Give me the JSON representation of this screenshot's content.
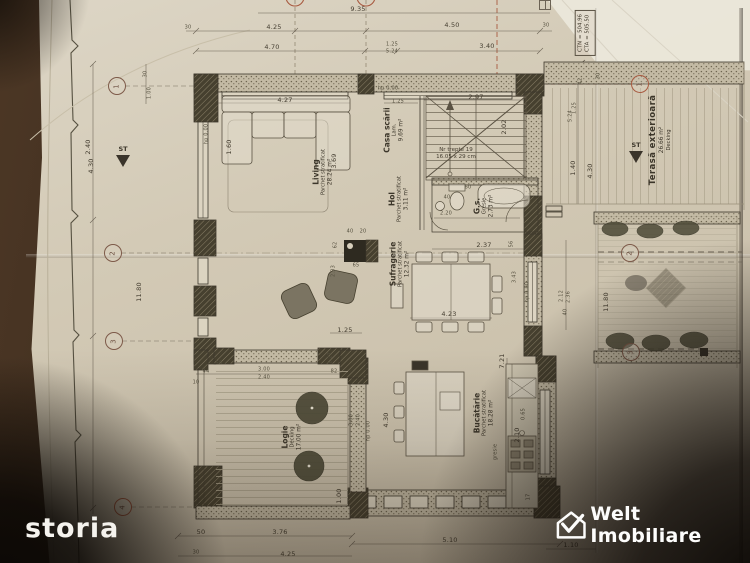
{
  "logos": {
    "storia": "storia",
    "welt": "Welt Imobiliare"
  },
  "site": {
    "ctn": "CTN = 504.96",
    "cta": "CTA = 505.50"
  },
  "rooms": {
    "living": {
      "name": "Living",
      "line2": "Parchet stratificat",
      "line3": "28.24 m²"
    },
    "casa_scarii": {
      "name": "Casa scării",
      "line2": "Lam.",
      "line3": "9.69 m²"
    },
    "hol": {
      "name": "Hol",
      "line2": "Parchet stratificat",
      "line3": "3.11 m²"
    },
    "gs": {
      "name": "G.s.",
      "line2": "Gresie",
      "line3": "2.73 m²"
    },
    "sufragerie": {
      "name": "Sufragerie",
      "line2": "Parchet stratificat",
      "line3": "12.32 m²"
    },
    "bucatarie": {
      "name": "Bucătărie",
      "line2": "Parchet stratificat",
      "line3": "18.28 m²"
    },
    "logie": {
      "name": "Logie",
      "line2": "Decking",
      "line3": "17.00 m²"
    },
    "terasa": {
      "name": "Terasă exterioară",
      "line2": "26.66 m²",
      "line3": "Decking"
    }
  },
  "stairs": {
    "line1": "Nr trepte 19",
    "line2": "16.05 x 29 cm"
  },
  "labels": {
    "st": "ST",
    "gresie": "gresie"
  },
  "grid": {
    "left": [
      "1",
      "2",
      "3",
      "4"
    ],
    "right": [
      "1",
      "2",
      "3"
    ]
  },
  "dims": [
    "9.35",
    "30",
    "4.25",
    "4.50",
    "30",
    "4.70",
    "1.25",
    "5.24",
    "3.40",
    "4.27",
    "1.25",
    "2.97",
    "hp 0.00",
    "hp 0.00",
    "1.60",
    "3.69",
    "2.02",
    "2.20",
    "40",
    "60",
    "2.37",
    "62",
    "65",
    "40",
    "20",
    "2.33",
    "4.23",
    "1.25",
    "3.00",
    "2.40",
    "44",
    "59",
    "82",
    "1.27",
    "3.00",
    "2.40",
    "hp 0.00",
    "1.00",
    "7.21",
    "0.65",
    "2.10",
    "4.30",
    "50",
    "3.76",
    "5.10",
    "30",
    "4.25",
    "1.10",
    "30",
    "42",
    "1.25",
    "5.24",
    "1.40",
    "4.30",
    "11.80",
    "11.80",
    "2.40",
    "4.30",
    "3.43",
    "56",
    "2.12",
    "2.36",
    "40",
    "30",
    "1.00",
    "17",
    "10",
    "hp 0.00"
  ]
}
